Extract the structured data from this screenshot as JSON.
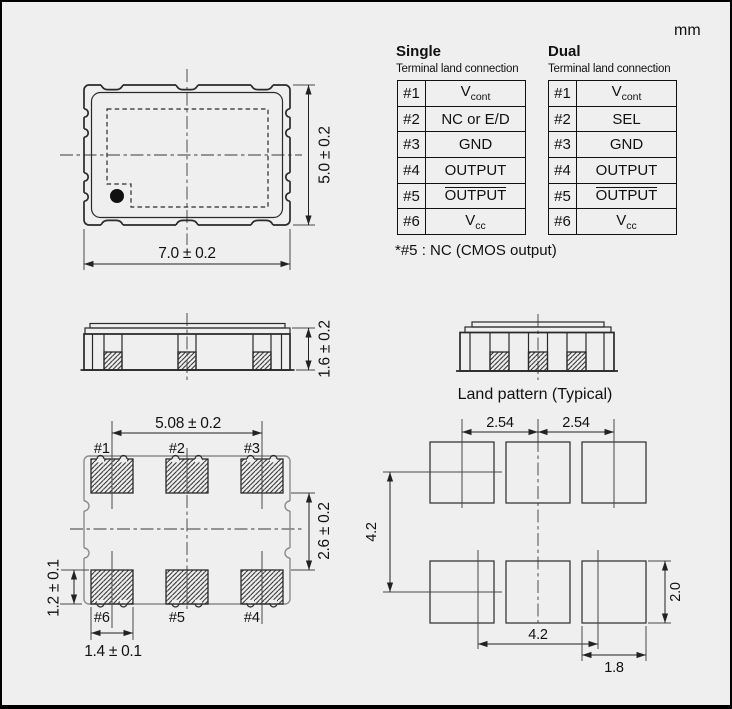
{
  "unit_label": "mm",
  "connection_tables": {
    "single": {
      "title": "Single",
      "subtitle": "Terminal land connection",
      "rows": [
        {
          "pin": "#1",
          "label": "V",
          "subscript": "cont"
        },
        {
          "pin": "#2",
          "label": "NC or E/D"
        },
        {
          "pin": "#3",
          "label": "GND"
        },
        {
          "pin": "#4",
          "label": "OUTPUT"
        },
        {
          "pin": "#5",
          "label": "OUTPUT"
        },
        {
          "pin": "#6",
          "label": "V",
          "subscript": "cc"
        }
      ]
    },
    "dual": {
      "title": "Dual",
      "subtitle": "Terminal land connection",
      "rows": [
        {
          "pin": "#1",
          "label": "V",
          "subscript": "cont"
        },
        {
          "pin": "#2",
          "label": "SEL"
        },
        {
          "pin": "#3",
          "label": "GND"
        },
        {
          "pin": "#4",
          "label": "OUTPUT"
        },
        {
          "pin": "#5",
          "label": "OUTPUT"
        },
        {
          "pin": "#6",
          "label": "V",
          "subscript": "cc"
        }
      ]
    },
    "footnote": "*#5 : NC (CMOS output)"
  },
  "top_view": {
    "width_dim": "7.0 ± 0.2",
    "height_dim": "5.0 ± 0.2"
  },
  "side_view": {
    "height_dim": "1.6 ± 0.2"
  },
  "bottom_view": {
    "pad_pitch_dim": "5.08 ± 0.2",
    "row_gap_dim": "2.6 ± 0.2",
    "pad_height_dim": "1.2 ± 0.1",
    "pad_width_dim": "1.4 ± 0.1",
    "top_pad_labels": [
      "#1",
      "#2",
      "#3"
    ],
    "bottom_pad_labels": [
      "#6",
      "#5",
      "#4"
    ]
  },
  "land_pattern": {
    "title": "Land pattern (Typical)",
    "pitch_dims": [
      "2.54",
      "2.54"
    ],
    "row_span_dim": "4.2",
    "col_span_dim": "4.2",
    "pad_height_dim": "2.0",
    "pad_width_dim": "1.8"
  }
}
